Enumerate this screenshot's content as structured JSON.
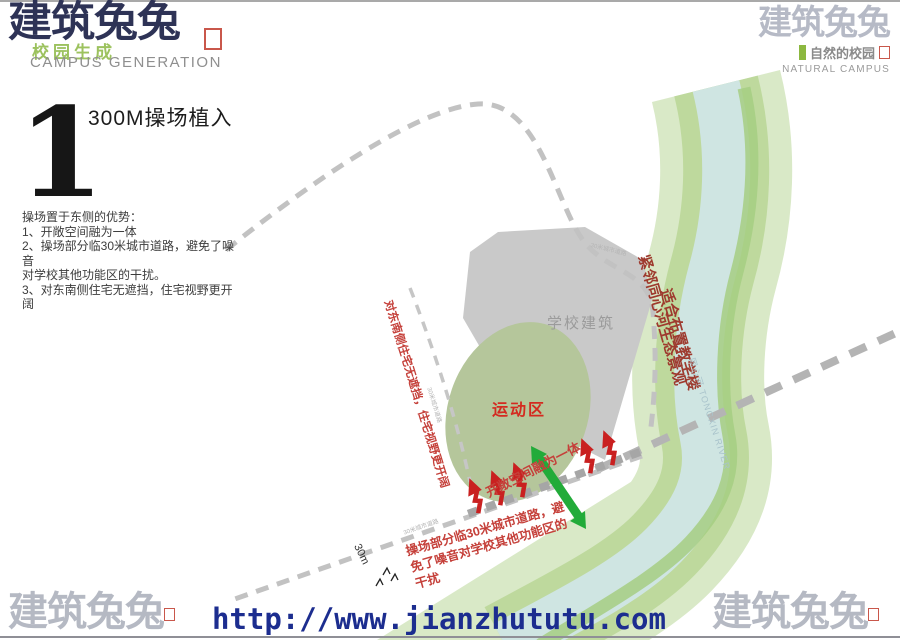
{
  "header": {
    "left": {
      "logo_text": "建筑兔兔",
      "overlay_text": "校园生成",
      "subtitle": "CAMPUS GENERATION"
    },
    "right": {
      "logo_text": "建筑兔兔",
      "tagline": "自然的校园",
      "subtitle": "NATURAL CAMPUS"
    }
  },
  "section": {
    "number": "1",
    "title": "300M操场植入"
  },
  "notes": {
    "lines": [
      "操场置于东侧的优势：",
      "1、开敞空间融为一体",
      "2、操场部分临30米城市道路，避免了噪音",
      "对学校其他功能区的干扰。",
      "3、对东南侧住宅无遮挡，住宅视野更开阔"
    ]
  },
  "plan": {
    "building_label": "学校建筑",
    "sports_label": "运动区",
    "dimension_label": "30m",
    "road_label": "30米城市道路",
    "river_label": "同心河 TONGXIN RIVER",
    "annotations": {
      "southwest_view": "对东南侧住宅无遮挡，住宅视野更开阔",
      "open_space": "开敞空间融为一体",
      "noise_lines": [
        "操场部分临30米城市道路，避",
        "免了噪音对学校其他功能区的",
        "干扰"
      ],
      "river_side_lines": [
        "紧邻同心河生态景观",
        "适合布置教学楼"
      ]
    }
  },
  "footer": {
    "left_logo": "建筑兔兔",
    "url": "http://www.jianzhututu.com",
    "right_logo": "建筑兔兔"
  },
  "colors": {
    "logo_navy": "#2e3356",
    "logo_gray": "#b6bac6",
    "seal_red": "#c0392b",
    "brand_green": "#8cb840",
    "annotation_red": "#c5403a",
    "annotation_dark_red": "#9e3a2e",
    "green_arrow": "#22ab39",
    "water_blue": "#cfe5e2",
    "bank_green": "#bed99d",
    "corridor_green": "#d9e9c7",
    "building_gray": "#c9c9c9",
    "url_blue": "#1c2d8f",
    "road_gray": "#c2c2c2"
  }
}
